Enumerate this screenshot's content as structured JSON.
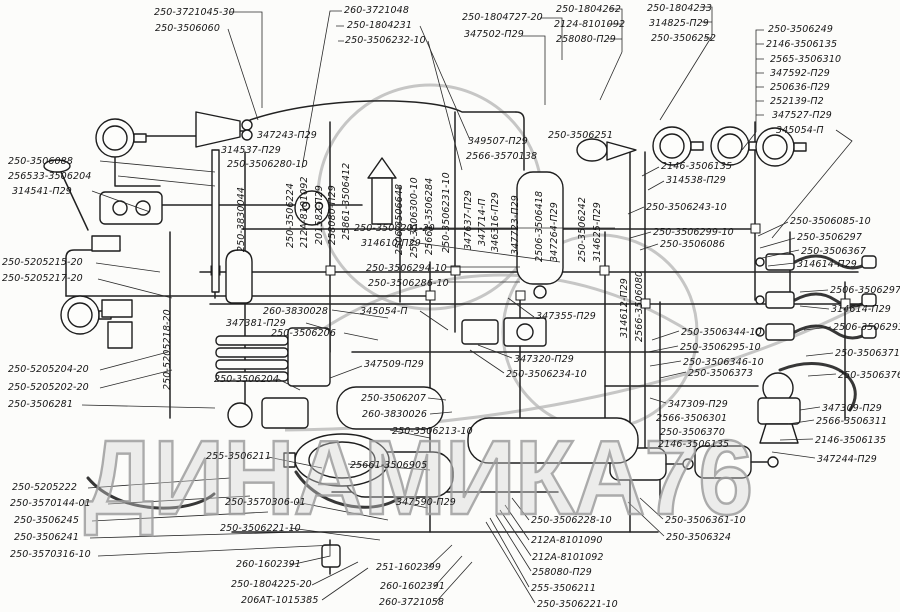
{
  "watermark": {
    "text": "ДИНАМИКА76",
    "color": "#b5b5b5"
  },
  "colors": {
    "ink": "#1f1f1f",
    "paper": "#fcfcfa"
  },
  "diagram": {
    "kind": "pneumatic-brake-system-parts-diagram",
    "labels": [
      {
        "t": "250-3721045-30",
        "x": 154,
        "y": 8
      },
      {
        "t": "250-3506060",
        "x": 155,
        "y": 24
      },
      {
        "t": "260-3721048",
        "x": 344,
        "y": 6
      },
      {
        "t": "250-1804231",
        "x": 347,
        "y": 21
      },
      {
        "t": "250-3506232-10",
        "x": 345,
        "y": 36
      },
      {
        "t": "250-1804727-20",
        "x": 462,
        "y": 13
      },
      {
        "t": "347502-П29",
        "x": 464,
        "y": 30
      },
      {
        "t": "250-1804262",
        "x": 556,
        "y": 5
      },
      {
        "t": "2124-8101092",
        "x": 554,
        "y": 20
      },
      {
        "t": "258080-П29",
        "x": 556,
        "y": 35
      },
      {
        "t": "250-1804233",
        "x": 647,
        "y": 4
      },
      {
        "t": "314825-П29",
        "x": 649,
        "y": 19
      },
      {
        "t": "250-3506252",
        "x": 651,
        "y": 34
      },
      {
        "t": "250-3506249",
        "x": 768,
        "y": 25
      },
      {
        "t": "2146-3506135",
        "x": 766,
        "y": 40
      },
      {
        "t": "2565-3506310",
        "x": 770,
        "y": 55
      },
      {
        "t": "347592-П29",
        "x": 770,
        "y": 69
      },
      {
        "t": "250636-П29",
        "x": 770,
        "y": 83
      },
      {
        "t": "252139-П2",
        "x": 770,
        "y": 97
      },
      {
        "t": "347527-П29",
        "x": 772,
        "y": 111
      },
      {
        "t": "345054-П",
        "x": 776,
        "y": 126
      },
      {
        "t": "250-3506088",
        "x": 8,
        "y": 157
      },
      {
        "t": "256533-3506204",
        "x": 8,
        "y": 172
      },
      {
        "t": "314541-П29",
        "x": 12,
        "y": 187
      },
      {
        "t": "347243-П29",
        "x": 257,
        "y": 131
      },
      {
        "t": "314537-П29",
        "x": 221,
        "y": 146
      },
      {
        "t": "250-3506280-10",
        "x": 227,
        "y": 160
      },
      {
        "t": "250-3506201-20",
        "x": 354,
        "y": 224
      },
      {
        "t": "314610-П29",
        "x": 361,
        "y": 239
      },
      {
        "t": "250-5205215-20",
        "x": 2,
        "y": 258
      },
      {
        "t": "250-5205217-20",
        "x": 2,
        "y": 274
      },
      {
        "t": "250-5205204-20",
        "x": 8,
        "y": 365
      },
      {
        "t": "250-5205202-20",
        "x": 8,
        "y": 383
      },
      {
        "t": "250-3506281",
        "x": 8,
        "y": 400
      },
      {
        "t": "250-5205222",
        "x": 12,
        "y": 483
      },
      {
        "t": "250-3570144-01",
        "x": 10,
        "y": 499
      },
      {
        "t": "250-3506245",
        "x": 14,
        "y": 516
      },
      {
        "t": "250-3506241",
        "x": 14,
        "y": 533
      },
      {
        "t": "250-3570316-10",
        "x": 10,
        "y": 550
      },
      {
        "t": "349507-П29",
        "x": 468,
        "y": 137
      },
      {
        "t": "2566-3570138",
        "x": 466,
        "y": 152
      },
      {
        "t": "250-3506251",
        "x": 548,
        "y": 131
      },
      {
        "t": "250-3506294-10",
        "x": 366,
        "y": 264
      },
      {
        "t": "250-3506286-10",
        "x": 368,
        "y": 279
      },
      {
        "t": "260-3830028",
        "x": 263,
        "y": 307
      },
      {
        "t": "347381-П29",
        "x": 226,
        "y": 319
      },
      {
        "t": "250-3506206",
        "x": 271,
        "y": 329
      },
      {
        "t": "345054-П",
        "x": 360,
        "y": 307
      },
      {
        "t": "347509-П29",
        "x": 364,
        "y": 360
      },
      {
        "t": "250-3506204",
        "x": 214,
        "y": 375
      },
      {
        "t": "250-3506207",
        "x": 361,
        "y": 394
      },
      {
        "t": "260-3830026",
        "x": 362,
        "y": 410
      },
      {
        "t": "347355-П29",
        "x": 536,
        "y": 312
      },
      {
        "t": "347320-П29",
        "x": 514,
        "y": 355
      },
      {
        "t": "250-3506234-10",
        "x": 506,
        "y": 370
      },
      {
        "t": "2146-3506135",
        "x": 661,
        "y": 162
      },
      {
        "t": "314538-П29",
        "x": 666,
        "y": 176
      },
      {
        "t": "250-3506243-10",
        "x": 646,
        "y": 203
      },
      {
        "t": "250-3506299-10",
        "x": 653,
        "y": 228
      },
      {
        "t": "250-3506086",
        "x": 660,
        "y": 240
      },
      {
        "t": "250-3506344-10",
        "x": 681,
        "y": 328
      },
      {
        "t": "250-3506295-10",
        "x": 680,
        "y": 343
      },
      {
        "t": "250-3506346-10",
        "x": 683,
        "y": 358
      },
      {
        "t": "250-3506373",
        "x": 688,
        "y": 369
      },
      {
        "t": "347309-П29",
        "x": 668,
        "y": 400
      },
      {
        "t": "2566-3506301",
        "x": 656,
        "y": 414
      },
      {
        "t": "250-3506370",
        "x": 660,
        "y": 428
      },
      {
        "t": "2146-3506135",
        "x": 658,
        "y": 440
      },
      {
        "t": "250-3506085-10",
        "x": 790,
        "y": 217
      },
      {
        "t": "250-3506297",
        "x": 797,
        "y": 233
      },
      {
        "t": "250-3506367",
        "x": 801,
        "y": 247
      },
      {
        "t": "314614-П29",
        "x": 797,
        "y": 260
      },
      {
        "t": "2506-3506297",
        "x": 830,
        "y": 286
      },
      {
        "t": "314614-П29",
        "x": 831,
        "y": 305
      },
      {
        "t": "2506-3506293",
        "x": 833,
        "y": 323
      },
      {
        "t": "250-3506371",
        "x": 835,
        "y": 349
      },
      {
        "t": "250-3506376",
        "x": 838,
        "y": 371
      },
      {
        "t": "347309-П29",
        "x": 822,
        "y": 404
      },
      {
        "t": "2566-3506311",
        "x": 816,
        "y": 417
      },
      {
        "t": "2146-3506135",
        "x": 815,
        "y": 436
      },
      {
        "t": "347244-П29",
        "x": 817,
        "y": 455
      },
      {
        "t": "255-3506211",
        "x": 206,
        "y": 452
      },
      {
        "t": "250-3570306-01",
        "x": 225,
        "y": 498
      },
      {
        "t": "250-3506221-10",
        "x": 220,
        "y": 524
      },
      {
        "t": "25661-3506905",
        "x": 350,
        "y": 461
      },
      {
        "t": "347590-П29",
        "x": 396,
        "y": 498
      },
      {
        "t": "250-3506213-10",
        "x": 392,
        "y": 427
      },
      {
        "t": "260-1602391",
        "x": 236,
        "y": 560
      },
      {
        "t": "250-1804225-20",
        "x": 231,
        "y": 580
      },
      {
        "t": "206АТ-1015385",
        "x": 241,
        "y": 596
      },
      {
        "t": "251-1602399",
        "x": 376,
        "y": 563
      },
      {
        "t": "260-1602391",
        "x": 380,
        "y": 582
      },
      {
        "t": "260-3721058",
        "x": 379,
        "y": 598
      },
      {
        "t": "250-3506228-10",
        "x": 531,
        "y": 516
      },
      {
        "t": "212А-8101090",
        "x": 531,
        "y": 536
      },
      {
        "t": "212А-8101092",
        "x": 532,
        "y": 553
      },
      {
        "t": "258080-П29",
        "x": 532,
        "y": 568
      },
      {
        "t": "255-3506211",
        "x": 531,
        "y": 584
      },
      {
        "t": "250-3506221-10",
        "x": 537,
        "y": 600
      },
      {
        "t": "250-3506361-10",
        "x": 665,
        "y": 516
      },
      {
        "t": "250-3506324",
        "x": 666,
        "y": 533
      },
      {
        "t": "250-3830044",
        "x": 237,
        "y": 252,
        "v": 1
      },
      {
        "t": "250-3506224",
        "x": 286,
        "y": 248,
        "v": 1
      },
      {
        "t": "212А-8101092",
        "x": 300,
        "y": 248,
        "v": 1
      },
      {
        "t": "201582-П29",
        "x": 315,
        "y": 245,
        "v": 1
      },
      {
        "t": "258080-П29",
        "x": 328,
        "y": 245,
        "v": 1
      },
      {
        "t": "25861-3506412",
        "x": 342,
        "y": 240,
        "v": 1
      },
      {
        "t": "2506-3506648",
        "x": 395,
        "y": 255,
        "v": 1
      },
      {
        "t": "250-3506300-10",
        "x": 410,
        "y": 258,
        "v": 1
      },
      {
        "t": "25661-3506284",
        "x": 425,
        "y": 255,
        "v": 1
      },
      {
        "t": "250-3506231-10",
        "x": 442,
        "y": 253,
        "v": 1
      },
      {
        "t": "347637-П29",
        "x": 464,
        "y": 250,
        "v": 1
      },
      {
        "t": "347714-П",
        "x": 478,
        "y": 246,
        "v": 1
      },
      {
        "t": "346316-П29",
        "x": 491,
        "y": 252,
        "v": 1
      },
      {
        "t": "347723-П29",
        "x": 511,
        "y": 255,
        "v": 1
      },
      {
        "t": "2506-3506418",
        "x": 535,
        "y": 262,
        "v": 1
      },
      {
        "t": "347264-П29",
        "x": 550,
        "y": 262,
        "v": 1
      },
      {
        "t": "250-3506242",
        "x": 578,
        "y": 262,
        "v": 1
      },
      {
        "t": "314625-П29",
        "x": 593,
        "y": 262,
        "v": 1
      },
      {
        "t": "314612-П29",
        "x": 620,
        "y": 338,
        "v": 1
      },
      {
        "t": "2566-3506080",
        "x": 635,
        "y": 342,
        "v": 1
      },
      {
        "t": "250-5205218-20",
        "x": 163,
        "y": 390,
        "v": 1
      }
    ]
  }
}
